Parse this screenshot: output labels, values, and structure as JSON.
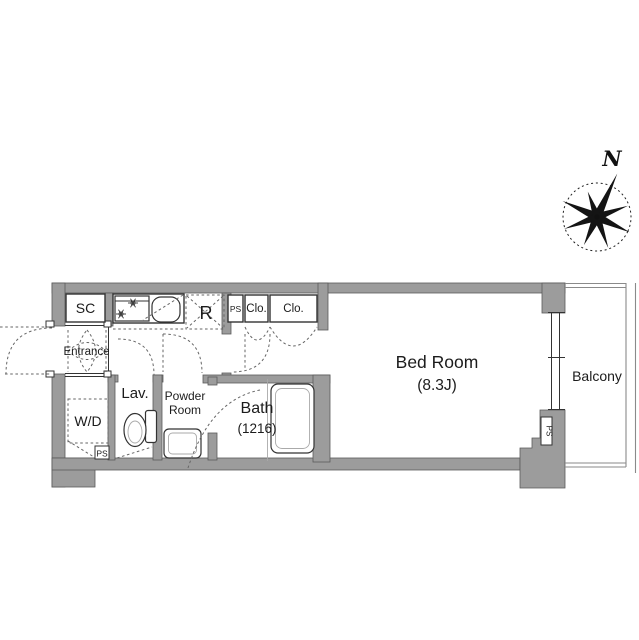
{
  "floor_plan": {
    "compass_north": "N",
    "rooms": {
      "shoe_closet": "SC",
      "entrance": "Entrance",
      "washer_dryer": "W/D",
      "pipe_space_lower": "PS",
      "lavatory": "Lav.",
      "powder_room_line1": "Powder",
      "powder_room_line2": "Room",
      "bath": "Bath",
      "bath_size": "(1216)",
      "refrigerator": "R",
      "pipe_space_upper": "PS",
      "closet_1": "Clo.",
      "closet_2": "Clo.",
      "bedroom": "Bed Room",
      "bedroom_size": "(8.3J)",
      "balcony": "Balcony",
      "pipe_space_right": "PS"
    },
    "colors": {
      "wall_fill": "#9c9c9c",
      "wall_edge": "#5a5a5a",
      "line": "#333333",
      "dash": "#666666",
      "text": "#1c1c1c",
      "background": "#ffffff"
    }
  }
}
